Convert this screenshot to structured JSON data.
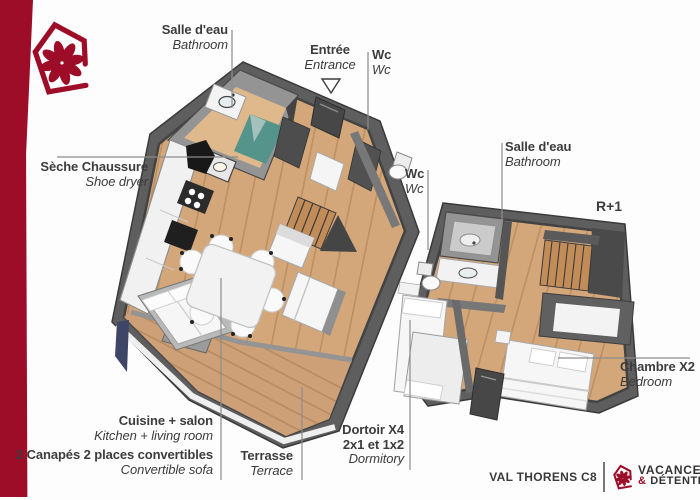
{
  "labels": {
    "bathroom_gf": {
      "fr": "Salle d'eau",
      "en": "Bathroom"
    },
    "entrance": {
      "fr": "Entrée",
      "en": "Entrance"
    },
    "wc_gf": {
      "fr": "Wc",
      "en": "Wc"
    },
    "shoe_dryer": {
      "fr": "Sèche Chaussure",
      "en": "Shoe dryer"
    },
    "wc_r1": {
      "fr": "Wc",
      "en": "Wc"
    },
    "bathroom_r1": {
      "fr": "Salle d'eau",
      "en": "Bathroom"
    },
    "floor_tag": "R+1",
    "bedroom": {
      "fr": "Chambre X2",
      "en": "Bedroom"
    },
    "dormitory": {
      "fr": "Dortoir X4",
      "fr2": "2x1 et 1x2",
      "en": "Dormitory"
    },
    "kitchen_living": {
      "fr": "Cuisine + salon",
      "en": "Kitchen + living room"
    },
    "sofas": {
      "fr": "2 Canapés 2 places convertibles",
      "en": "Convertible sofa"
    },
    "terrace": {
      "fr": "Terrasse",
      "en": "Terrace"
    }
  },
  "footer": {
    "unit": "VAL THORENS C8"
  },
  "brand": {
    "line1": "VACANCES",
    "amp": "&",
    "line2": "DÉTENTE"
  },
  "colors": {
    "brand_red": "#9D0D28",
    "text": "#3C3C3C",
    "line": "#8C8C8C",
    "wood": "#D4A77A",
    "wood_light": "#DFB88C",
    "wood_deck": "#CDA077",
    "stair_wood": "#C28C59",
    "wall": "#949494",
    "wall_dark": "#5E5E5E",
    "wall_deep": "#434343",
    "white_furn": "#F6F6F6",
    "teal": "#55948B",
    "navy": "#3E4566"
  }
}
